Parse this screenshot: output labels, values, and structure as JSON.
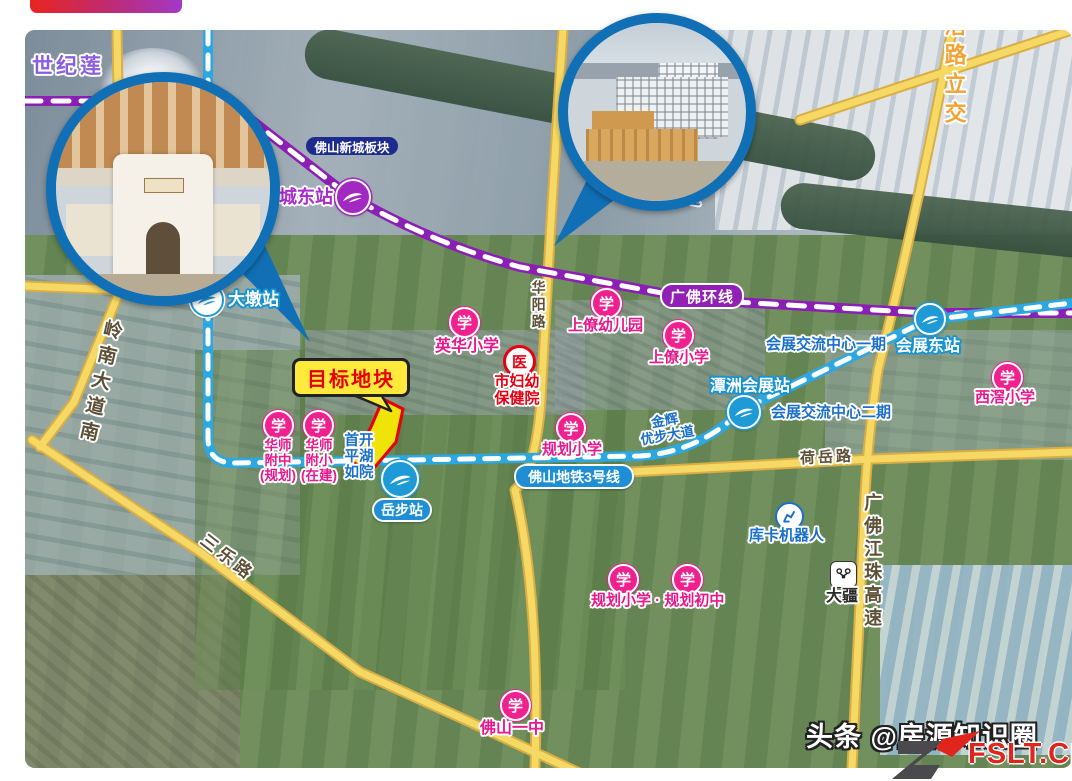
{
  "watermark": {
    "platform": "头条",
    "handle": "@房源知识圈",
    "site": "FSLT.CN"
  },
  "map_labels": {
    "century_lotus": "世纪莲",
    "newtown_block": "佛山新城板块",
    "river": "潭洲水道",
    "interchange": "滘路立交",
    "loop_line": "广佛环线",
    "metro_line3": "佛山地铁3号线",
    "target_plot": "目标地块"
  },
  "stations": {
    "dongping": "东平站",
    "xinchengdong": "新城东站",
    "dadun": "大墩站",
    "yuebu": "岳步站",
    "tanzhou_expo": "潭洲会展站",
    "expo_east": "会展东站"
  },
  "roads": {
    "lingnan": "岭南大道南",
    "sanle": "三乐路",
    "huayang": "华阳路",
    "heyue": "荷岳路",
    "gfjz_expressway": "广佛江珠高速"
  },
  "schools": {
    "badge": "学",
    "yinghua": "英华小学",
    "shangliao_kindergarten": "上僚幼儿园",
    "shangliao_primary": "上僚小学",
    "xijiao": "西滘小学",
    "hsfz_lines": [
      "华师",
      "附中",
      "(规划)"
    ],
    "hsfx_lines": [
      "华师",
      "附小",
      "(在建)"
    ],
    "planned_primary": "规划小学",
    "planned_combo": "规划小学 · 规划初中",
    "foshan_no1": "佛山一中"
  },
  "hospital": {
    "badge": "医",
    "name_line1": "市妇幼",
    "name_line2": "保健院"
  },
  "projects": {
    "shoukai_lines": [
      "首开",
      "平湖",
      "如院"
    ],
    "jinhui_lines": [
      "金辉",
      "优步大道"
    ],
    "expo_center_phase1": "会展交流中心一期",
    "expo_center_phase2": "会展交流中心二期",
    "kuka": "库卡机器人",
    "dji": "大疆"
  },
  "icons": {
    "metro_logo": "metro-swoosh-icon",
    "school": "school-badge-icon",
    "hospital": "hospital-badge-icon",
    "kuka": "robot-arm-icon",
    "dji": "drone-icon",
    "inset_callout": "photo-callout-circle"
  },
  "colors": {
    "school_pink": "#f0218f",
    "hospital_red": "#e60012",
    "metro_blue": "#1e9ad6",
    "loop_purple": "#9320b4",
    "road_yellow": "#f6d964",
    "target_yellow": "#ffe93b",
    "target_border_red": "#e60000",
    "project_label_blue": "#1a6fc9",
    "station_label_purple": "#a92ad1",
    "watermark_red": "#e0251c",
    "inset_ring_blue": "#1170b5"
  }
}
